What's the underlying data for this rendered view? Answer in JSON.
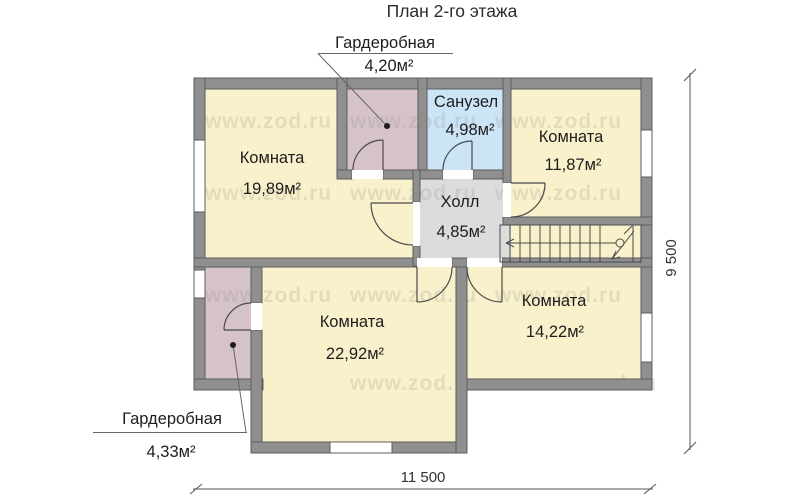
{
  "title": "План 2-го этажа",
  "watermark_text": "www.zod.ru",
  "rooms": {
    "room_top_left": {
      "name": "Комната",
      "area": "19,89м²"
    },
    "room_top_right": {
      "name": "Комната",
      "area": "11,87м²"
    },
    "room_bottom_mid": {
      "name": "Комната",
      "area": "22,92м²"
    },
    "room_bottom_right": {
      "name": "Комната",
      "area": "14,22м²"
    },
    "bathroom": {
      "name": "Санузел",
      "area": "4,98м²"
    },
    "hall": {
      "name": "Холл",
      "area": "4,85м²"
    },
    "wardrobe_top": {
      "name": "Гардеробная",
      "area": "4,20м²"
    },
    "wardrobe_bottom": {
      "name": "Гардеробная",
      "area": "4,33м²"
    }
  },
  "dimensions": {
    "overall_width": "11 500",
    "overall_height": "9 500"
  },
  "colors": {
    "room_fill": "#f9f1cb",
    "wardrobe_fill": "#d6c3c8",
    "bathroom_fill": "#cbe4f6",
    "hall_fill": "#dcdcdc",
    "wall_fill": "#8f8f8f",
    "wall_edge": "#5c5c5c",
    "background": "#ffffff"
  }
}
